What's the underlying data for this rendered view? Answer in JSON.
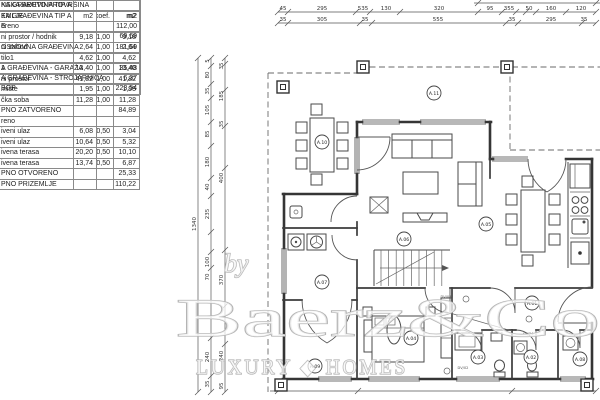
{
  "drawing": {
    "tables": {
      "bruto": {
        "rows": [
          {
            "label": "NSKA BRUTO PROVRŠINA",
            "v": ""
          },
          {
            "label": "KA GRAĐEVINA TIP A",
            "v": "m2"
          },
          {
            "label": "E",
            "v": "112,00"
          },
          {
            "label": "",
            "v": "69,69"
          },
          {
            "label": "OSNOVNA GRAĐEVINA",
            "v": "181,69"
          },
          {
            "label": "",
            "v": ""
          },
          {
            "label": "A GRAĐEVINA - GARAŽA",
            "v": "35,48"
          },
          {
            "label": "A GRAĐEVINA - STROJARNICA",
            "v": "6,37"
          },
          {
            "label": "BGP",
            "v": "223,54"
          }
        ]
      },
      "neto": {
        "rows": [
          {
            "label": "KA GRAĐEVINA TIP A",
            "c1": "",
            "c2": "",
            "c3": ""
          },
          {
            "label": "EMLJE",
            "c1": "m2",
            "c2": "koef.",
            "c3": "m2"
          },
          {
            "label": "oreno",
            "c1": "",
            "c2": "",
            "c3": ""
          },
          {
            "label": "ni prostor / hodnik",
            "c1": "9,18",
            "c2": "1,00",
            "c3": "9,18"
          },
          {
            "label": "ni zahod",
            "c1": "2,64",
            "c2": "1,00",
            "c3": "2,64"
          },
          {
            "label": "tilo1",
            "c1": "4,62",
            "c2": "1,00",
            "c3": "4,62"
          },
          {
            "label": "1",
            "c1": "13,40",
            "c2": "1,00",
            "c3": "13,40"
          },
          {
            "label": "ni prostor",
            "c1": "41,82",
            "c2": "1,00",
            "c3": "41,82"
          },
          {
            "label": "mište",
            "c1": "1,95",
            "c2": "1,00",
            "c3": "1,95"
          },
          {
            "label": "čka soba",
            "c1": "11,28",
            "c2": "1,00",
            "c3": "11,28"
          },
          {
            "label": "PNO ZATVORENO",
            "c1": "",
            "c2": "",
            "c3": "84,89"
          },
          {
            "label": "reno",
            "c1": "",
            "c2": "",
            "c3": ""
          },
          {
            "label": "iveni ulaz",
            "c1": "6,08",
            "c2": "0,50",
            "c3": "3,04"
          },
          {
            "label": "iveni ulaz",
            "c1": "10,64",
            "c2": "0,50",
            "c3": "5,32"
          },
          {
            "label": "ivena terasa",
            "c1": "20,20",
            "c2": "0,50",
            "c3": "10,10"
          },
          {
            "label": "ivena terasa",
            "c1": "13,74",
            "c2": "0,50",
            "c3": "6,87"
          },
          {
            "label": "PNO OTVORENO",
            "c1": "",
            "c2": "",
            "c3": "25,33"
          },
          {
            "label": "PNO PRIZEMLJE",
            "c1": "",
            "c2": "",
            "c3": "110,22"
          }
        ]
      }
    },
    "dims": {
      "horizontal": [
        {
          "name": "top-chain-1",
          "y": 12,
          "x1": 278,
          "x2": 596,
          "ticks": [
            278,
            288,
            356,
            370,
            400,
            478,
            502,
            516,
            526,
            536,
            566,
            596
          ],
          "labels": [
            {
              "t": "45",
              "x": 283
            },
            {
              "t": "295",
              "x": 322
            },
            {
              "t": "535",
              "x": 363
            },
            {
              "t": "130",
              "x": 386
            },
            {
              "t": "320",
              "x": 439
            },
            {
              "t": "95",
              "x": 490
            },
            {
              "t": "355",
              "x": 509
            },
            {
              "t": "50",
              "x": 529
            },
            {
              "t": "160",
              "x": 551
            },
            {
              "t": "120",
              "x": 581
            }
          ]
        },
        {
          "name": "top-chain-2",
          "y": 23,
          "x1": 278,
          "x2": 596,
          "ticks": [
            278,
            288,
            360,
            372,
            506,
            518,
            582,
            596
          ],
          "labels": [
            {
              "t": "35",
              "x": 283
            },
            {
              "t": "305",
              "x": 322
            },
            {
              "t": "35",
              "x": 365
            },
            {
              "t": "555",
              "x": 438
            },
            {
              "t": "35",
              "x": 512
            },
            {
              "t": "295",
              "x": 551
            },
            {
              "t": "35",
              "x": 584
            }
          ]
        },
        {
          "name": "top-edge",
          "y": 3,
          "x1": 474,
          "x2": 600,
          "ticks": [
            478,
            596
          ],
          "labels": []
        },
        {
          "name": "bottom-chain",
          "y": 391,
          "x1": 270,
          "x2": 596,
          "ticks": [
            278,
            358,
            512,
            596
          ],
          "labels": []
        }
      ],
      "vertical": [
        {
          "name": "left-total",
          "x": 198,
          "y1": 58,
          "y2": 392,
          "ticks": [
            58,
            392
          ],
          "labels": [
            {
              "t": "1340",
              "y": 224
            }
          ]
        },
        {
          "name": "left-chain-1",
          "x": 211,
          "y1": 58,
          "y2": 392,
          "ticks": [
            58,
            66,
            84,
            98,
            122,
            146,
            178,
            196,
            232,
            252,
            268,
            338,
            376,
            392
          ],
          "labels": [
            {
              "t": "5",
              "y": 61
            },
            {
              "t": "80",
              "y": 75
            },
            {
              "t": "35",
              "y": 91
            },
            {
              "t": "105",
              "y": 110
            },
            {
              "t": "85",
              "y": 134
            },
            {
              "t": "180",
              "y": 162
            },
            {
              "t": "40",
              "y": 187
            },
            {
              "t": "235",
              "y": 214
            },
            {
              "t": "100",
              "y": 262
            },
            {
              "t": "70",
              "y": 277
            },
            {
              "t": "240",
              "y": 357
            },
            {
              "t": "35",
              "y": 384
            }
          ]
        },
        {
          "name": "left-chain-2",
          "x": 225,
          "y1": 58,
          "y2": 392,
          "ticks": [
            58,
            64,
            90,
            126,
            168,
            250,
            306,
            344,
            392
          ],
          "labels": [
            {
              "t": "35",
              "y": 66
            },
            {
              "t": "185",
              "y": 96
            },
            {
              "t": "35",
              "y": 124
            },
            {
              "t": "400",
              "y": 178
            },
            {
              "t": "370",
              "y": 280
            },
            {
              "t": "240",
              "y": 356
            },
            {
              "t": "95",
              "y": 386
            }
          ]
        }
      ]
    },
    "room_labels": [
      {
        "id": "A.01",
        "x": 532,
        "y": 303
      },
      {
        "id": "A.02",
        "x": 531,
        "y": 357
      },
      {
        "id": "A.03",
        "x": 478,
        "y": 357
      },
      {
        "id": "A.04",
        "x": 411,
        "y": 338
      },
      {
        "id": "A.05",
        "x": 486,
        "y": 224
      },
      {
        "id": "A.06",
        "x": 404,
        "y": 239
      },
      {
        "id": "A.07",
        "x": 322,
        "y": 282
      },
      {
        "id": "A.08",
        "x": 580,
        "y": 359
      },
      {
        "id": "A.09",
        "x": 315,
        "y": 366
      },
      {
        "id": "A.10",
        "x": 322,
        "y": 142
      },
      {
        "id": "A.11",
        "x": 434,
        "y": 93
      }
    ],
    "columns": [
      {
        "x": 363,
        "y": 67
      },
      {
        "x": 507,
        "y": 67
      },
      {
        "x": 283,
        "y": 87
      },
      {
        "x": 281,
        "y": 385
      },
      {
        "x": 587,
        "y": 385
      }
    ],
    "door_tags": [
      {
        "t": "DV/08",
        "x": 446,
        "y": 298
      },
      {
        "t": "SV/74",
        "x": 528,
        "y": 335
      },
      {
        "t": "DV/02",
        "x": 463,
        "y": 369
      }
    ],
    "watermark": {
      "by": "by",
      "brand": "Baerz&Co",
      "tagline": "LUXURY ◆ HOMES"
    },
    "colors": {
      "line": "#3c3c3c",
      "dim": "#555555",
      "watermark": "#b4b4b4"
    }
  }
}
